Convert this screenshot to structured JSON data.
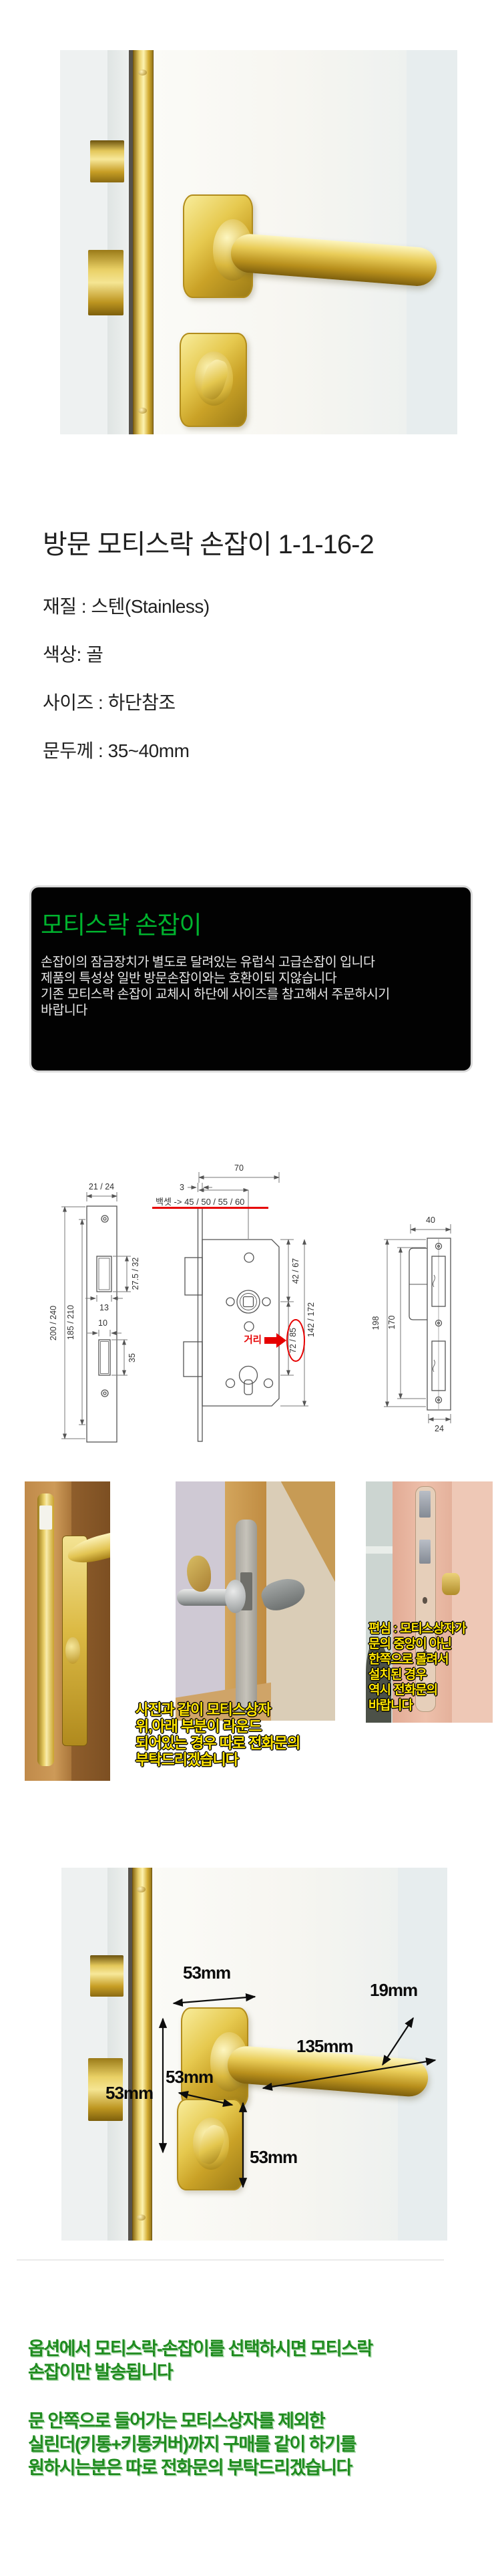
{
  "title": "방문 모티스락 손잡이 1-1-16-2",
  "specs": {
    "material": "재질 : 스텐(Stainless)",
    "color": "색상: 골",
    "size": "사이즈 : 하단참조",
    "door_thickness": "문두께 : 35~40mm"
  },
  "info_box": {
    "heading": "모티스락 손잡이",
    "heading_color": "#00b32e",
    "bg": "#020202",
    "lines": [
      "손잡이의 잠금장치가 별도로 달려있는 유럽식 고급손잡이 입니다",
      "제품의 특성상 일반 방문손잡이와는 호환이되 지않습니다",
      "기존 모티스락 손잡이 교체시 하단에 사이즈를 참고해서 주문하시기",
      "바랍니다"
    ]
  },
  "diagram": {
    "accent_color": "#e60000",
    "left": {
      "plate_width": "21 / 24",
      "total_height": "200 / 240",
      "inner_height": "185 / 210",
      "latch_height": "27.5 / 32",
      "latch_width": "13",
      "bolt_width": "10",
      "bolt_height": "35"
    },
    "middle": {
      "body_depth": "70",
      "face_thickness": "3",
      "backset": "백셋 -> 45 / 50 / 55 / 60",
      "top_to_hub": "42 / 67",
      "hub_to_cylinder": "72 / 85",
      "total_height": "142 / 172",
      "distance_label": "거리"
    },
    "right": {
      "plate_width": "40",
      "total_height": "198",
      "hole_span": "170",
      "plate_depth": "24"
    }
  },
  "captions": {
    "color": "#ffe400",
    "mid": [
      "사진과 같이 모티스상자",
      "위,아래 부분이 라운드",
      "되어있는 경우 따로 전화문의",
      "부탁드리겠습니다"
    ],
    "right": [
      "편심 : 모티스상자가",
      "문의 중앙이 아닌",
      "한쪽으로 몰려서",
      "설치된 경우",
      "역시 전화문의",
      "바랍니다"
    ]
  },
  "big_photo": {
    "labels": [
      "53mm",
      "19mm",
      "135mm",
      "53mm",
      "53mm",
      "53mm"
    ]
  },
  "notes": {
    "color": "#1f8b1f",
    "block1": [
      "옵션에서 모티스락-손잡이를 선택하시면 모티스락",
      "손잡이만 발송됩니다"
    ],
    "block2": [
      "문 안쪽으로 들어가는 모티스상자를 제외한",
      "실린더(키통+키통커버)까지 구매를 같이 하기를",
      "원하시는분은 따로 전화문의 부탁드리겠습니다"
    ]
  }
}
